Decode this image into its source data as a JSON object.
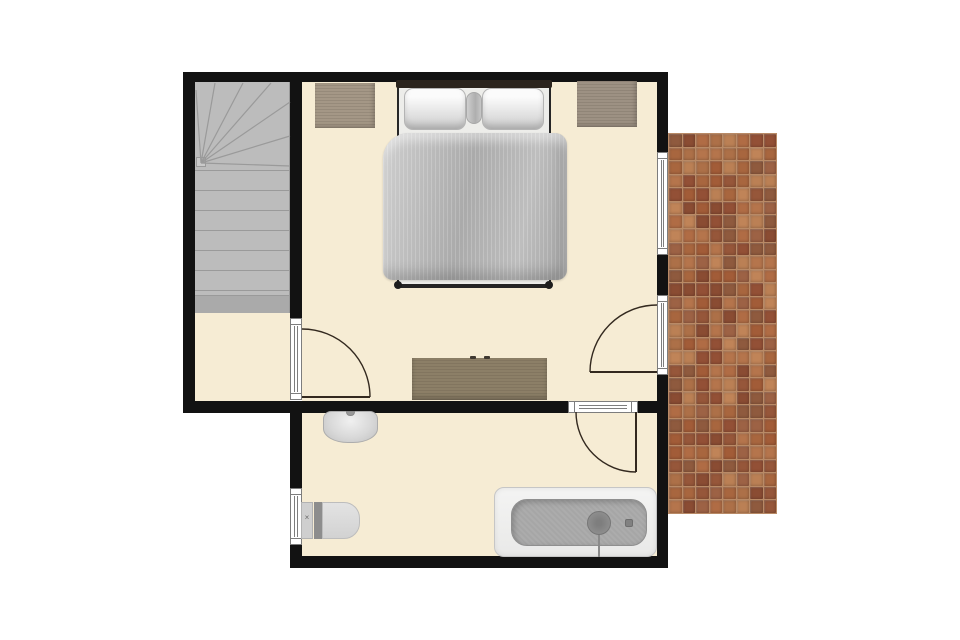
{
  "title": "Upper floor plan with bedroom, staircase, bathroom and tiled terrace",
  "canvas": {
    "w": 960,
    "h": 640
  },
  "colors": {
    "background": "#ffffff",
    "floor": "#f6ecd4",
    "wall": "#121212",
    "frame_line": "#7d7d7d",
    "stair": "#bcbcbc",
    "stair_line": "#9a9a9a",
    "stair_last_band": "#aaaaaa",
    "stair_hub": "#c9c9c9",
    "door_arc": "#33291f",
    "grout": "#b98a66",
    "wood_light": "#a49786",
    "wood_mid": "#9d9183",
    "wood_dark": "#8c7f67",
    "headboard": "#2b241d",
    "duvet": "#b5b5b5",
    "fixture_light": "#e6e6e6",
    "tub_inner": "#a6a6a6"
  },
  "rooms": [
    {
      "name": "stair-hall",
      "x": 195,
      "y": 82,
      "w": 95,
      "h": 319
    },
    {
      "name": "bedroom",
      "x": 302,
      "y": 82,
      "w": 355,
      "h": 319
    },
    {
      "name": "bathroom",
      "x": 302,
      "y": 413,
      "w": 355,
      "h": 143
    }
  ],
  "walls": [
    {
      "name": "top",
      "x": 183,
      "y": 72,
      "w": 485,
      "h": 10
    },
    {
      "name": "left",
      "x": 183,
      "y": 82,
      "w": 12,
      "h": 331
    },
    {
      "name": "stair-divider",
      "x": 290,
      "y": 82,
      "w": 12,
      "h": 236
    },
    {
      "name": "mid-horizontal-left",
      "x": 183,
      "y": 401,
      "w": 385,
      "h": 12
    },
    {
      "name": "mid-horizontal-right",
      "x": 638,
      "y": 401,
      "w": 30,
      "h": 12
    },
    {
      "name": "bath-left-upper",
      "x": 290,
      "y": 413,
      "w": 12,
      "h": 75
    },
    {
      "name": "bath-left-lower",
      "x": 290,
      "y": 545,
      "w": 12,
      "h": 23
    },
    {
      "name": "bath-bottom",
      "x": 290,
      "y": 556,
      "w": 378,
      "h": 12
    },
    {
      "name": "right-upper",
      "x": 657,
      "y": 82,
      "w": 11,
      "h": 70
    },
    {
      "name": "right-mid",
      "x": 657,
      "y": 255,
      "w": 11,
      "h": 40
    },
    {
      "name": "right-lower",
      "x": 657,
      "y": 375,
      "w": 11,
      "h": 193
    }
  ],
  "openings": [
    {
      "name": "bedroom-window",
      "kind": "window",
      "x": 657,
      "y": 152,
      "w": 11,
      "h": 103,
      "o": "v"
    },
    {
      "name": "terrace-door-threshold",
      "kind": "door",
      "x": 657,
      "y": 295,
      "w": 11,
      "h": 80,
      "o": "v"
    },
    {
      "name": "stair-door-threshold",
      "kind": "door",
      "x": 290,
      "y": 318,
      "w": 12,
      "h": 82,
      "o": "v"
    },
    {
      "name": "bathroom-door-threshold",
      "kind": "door",
      "x": 568,
      "y": 401,
      "w": 70,
      "h": 12,
      "o": "h"
    },
    {
      "name": "bathroom-window",
      "kind": "window",
      "x": 290,
      "y": 488,
      "w": 12,
      "h": 57,
      "o": "v"
    }
  ],
  "doors": [
    {
      "name": "stair-door",
      "leaf": [
        302,
        397,
        370,
        397
      ],
      "arc": "M 370 397 A 68 68 0 0 0 302 329"
    },
    {
      "name": "terrace-door",
      "leaf": [
        590,
        372,
        657,
        372
      ],
      "arc": "M 590 372 A 67 67 0 0 1 657 305"
    },
    {
      "name": "bathroom-door",
      "leaf": [
        636,
        412,
        636,
        472
      ],
      "arc": "M 636 472 A 60 60 0 0 1 576 412"
    }
  ],
  "stairs": {
    "x": 195,
    "y": 82,
    "w": 95,
    "h": 231,
    "treads": [
      170,
      190,
      210,
      230,
      250,
      270,
      290
    ],
    "last_band": {
      "y": 295,
      "h": 18
    },
    "hub": {
      "x": 196,
      "y": 157,
      "w": 10,
      "h": 10
    },
    "winders": [
      [
        201,
        163,
        196,
        90
      ],
      [
        201,
        163,
        215,
        83
      ],
      [
        201,
        163,
        243,
        83
      ],
      [
        201,
        163,
        271,
        83
      ],
      [
        201,
        163,
        290,
        102
      ],
      [
        201,
        163,
        290,
        136
      ],
      [
        201,
        163,
        290,
        166
      ]
    ]
  },
  "bedroom_furniture": {
    "bed": {
      "headboard": {
        "x": 396,
        "y": 80,
        "w": 156,
        "h": 8
      },
      "sheet": {
        "x": 399,
        "y": 84,
        "w": 150,
        "h": 202
      },
      "rails": [
        {
          "x": 397,
          "y": 84,
          "w": 2,
          "h": 204
        },
        {
          "x": 549,
          "y": 84,
          "w": 2,
          "h": 204
        }
      ],
      "pillows": [
        {
          "x": 404,
          "y": 88,
          "w": 62,
          "h": 42
        },
        {
          "x": 482,
          "y": 88,
          "w": 62,
          "h": 42
        }
      ],
      "bolster": {
        "x": 466,
        "y": 92,
        "w": 16,
        "h": 32
      },
      "duvet": {
        "x": 383,
        "y": 133,
        "w": 184,
        "h": 147
      },
      "footbar": {
        "x": 398,
        "y": 284,
        "w": 152,
        "h": 4
      },
      "knobs": [
        {
          "x": 394,
          "y": 281,
          "w": 8,
          "h": 8
        },
        {
          "x": 545,
          "y": 281,
          "w": 8,
          "h": 8
        }
      ]
    },
    "nightstands": [
      {
        "name": "nightstand-left",
        "x": 315,
        "y": 83,
        "w": 60,
        "h": 45
      },
      {
        "name": "nightstand-right",
        "x": 577,
        "y": 81,
        "w": 60,
        "h": 46
      }
    ],
    "dresser": {
      "x": 412,
      "y": 358,
      "w": 135,
      "h": 42,
      "knobs": [
        {
          "x": 470,
          "y": 356,
          "w": 6,
          "h": 3
        },
        {
          "x": 484,
          "y": 356,
          "w": 6,
          "h": 3
        }
      ]
    }
  },
  "bathroom_fixtures": {
    "sink": {
      "x": 323,
      "y": 411,
      "w": 55,
      "h": 32,
      "faucet": {
        "x": 346,
        "y": 411,
        "w": 9,
        "h": 5
      }
    },
    "toilet": {
      "tank": {
        "x": 301,
        "y": 502,
        "w": 12,
        "h": 37
      },
      "lid": {
        "x": 314,
        "y": 502,
        "w": 8,
        "h": 37
      },
      "bowl": {
        "x": 322,
        "y": 502,
        "w": 38,
        "h": 37
      },
      "mark": "×",
      "mark_pos": {
        "x": 302,
        "y": 513,
        "w": 10,
        "h": 10
      }
    },
    "bathtub": {
      "outer": {
        "x": 494,
        "y": 487,
        "w": 163,
        "h": 70
      },
      "inner": {
        "x": 511,
        "y": 499,
        "w": 136,
        "h": 47
      },
      "drain": {
        "cx": 599,
        "cy": 523,
        "r": 12
      },
      "overflow": {
        "x": 598,
        "y": 534,
        "w": 2,
        "h": 23
      },
      "faucet": {
        "x": 625,
        "y": 519,
        "w": 8,
        "h": 8
      }
    }
  },
  "terrace": {
    "x": 668,
    "y": 133,
    "w": 109,
    "h": 381,
    "cols": 8,
    "rows": 28,
    "palette": [
      "#a8663f",
      "#96573a",
      "#b5754c",
      "#8a4c33",
      "#c08458",
      "#9d6245",
      "#b06c45",
      "#8f5a3e",
      "#bb8055",
      "#a25c38",
      "#935036",
      "#ad7048"
    ]
  }
}
